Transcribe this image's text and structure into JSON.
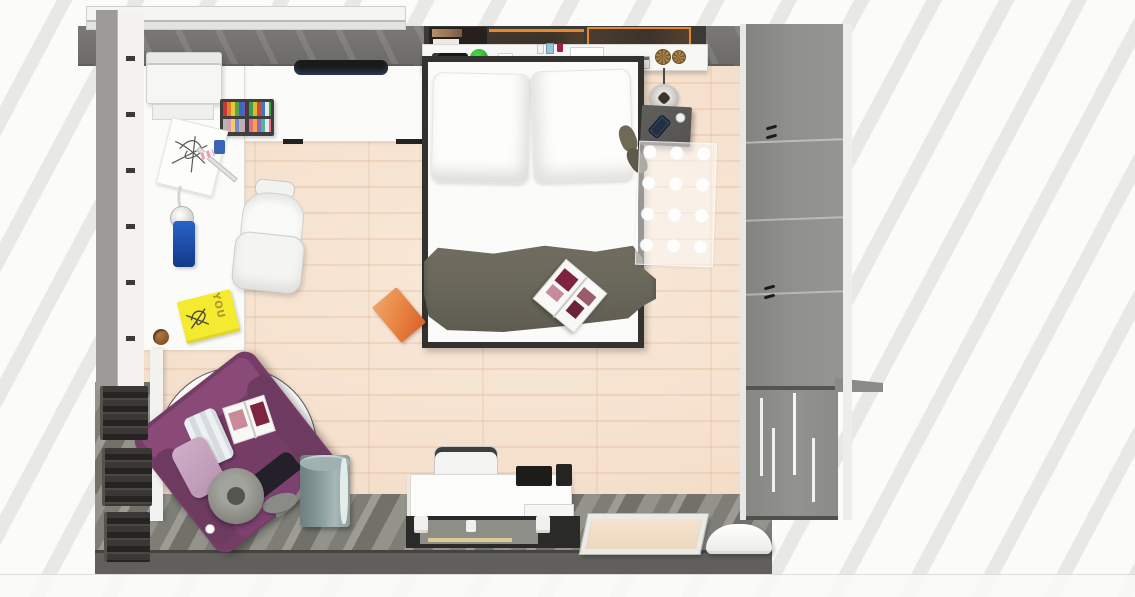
{
  "scene": {
    "description": "Top-down 3D rendering of a furnished bedroom with bed, corner desk, wardrobe and purple armchair"
  },
  "colors": {
    "wood_floor": "#f4dfcb",
    "wood_floor_light": "#f9e9d9",
    "wood_floor_dark": "#eed2b8",
    "gray_floor_a": "#93938c",
    "gray_floor_b": "#7e7e77",
    "gray_floor_c": "#9c9c95",
    "gray_floor_d": "#71716a",
    "desk_white": "#fbfbf9",
    "wall_gray": "#72716f",
    "wall_bottom": "#605f5b",
    "wardrobe_gray": "#8b8b89",
    "bed_frame": "#34322e",
    "blanket_gray": "#6b685c",
    "chair_purple": "#753d66",
    "chair_purple_light": "#8a4a78",
    "poster_orange": "#e8862a",
    "plant_green": "#2db92d",
    "bottle_blue": "#2a62c8",
    "book_yellow": "#f4ea2f",
    "book_orange": "#e8813f",
    "bin_teal": "#8da0a0",
    "basket_brown": "#9a7a4a",
    "magazine_maroon": "#7e2440",
    "magazine_pink": "#c98a9a"
  },
  "objects": {
    "window": {
      "label": "Window with white frame"
    },
    "posters": {
      "label": "Wall posters with orange frames"
    },
    "printer": {
      "label": "White printer"
    },
    "wall_monitor": {
      "label": "Black wall-mounted monitor"
    },
    "art_set": {
      "label": "Open art supplies case"
    },
    "sketch": {
      "label": "Sketch paper with drawing"
    },
    "ruler": {
      "label": "Ruler"
    },
    "desk_lamp": {
      "label": "Desk lamp"
    },
    "blue_bottle": {
      "label": "Blue bottle"
    },
    "you_book": {
      "label": "Yellow book",
      "text": "YOU"
    },
    "cookie": {
      "label": "Cookie"
    },
    "office_chair": {
      "label": "White office chair"
    },
    "corner_desk": {
      "label": "White corner desk"
    },
    "bed": {
      "label": "Double bed with white linen"
    },
    "pillow_left": {
      "label": "Pillow"
    },
    "pillow_right": {
      "label": "Pillow"
    },
    "blanket": {
      "label": "Dark grey blanket"
    },
    "bed_magazine": {
      "label": "Open magazine on bed"
    },
    "orange_book": {
      "label": "Orange book on floor"
    },
    "headboard_shelf": {
      "label": "Headboard shelf"
    },
    "remote": {
      "label": "Black remote"
    },
    "plant": {
      "label": "Small green plant"
    },
    "keyboard": {
      "label": "Keyboard on shelf"
    },
    "baskets": {
      "label": "Woven baskets"
    },
    "pendant_lamp": {
      "label": "Pendant lamp"
    },
    "nightstand": {
      "label": "Grey nightstand"
    },
    "phone": {
      "label": "Smartphone"
    },
    "mug": {
      "label": "White mug"
    },
    "slippers": {
      "label": "Slippers"
    },
    "sheer_rug": {
      "label": "Sheer dotted runner rug"
    },
    "wardrobe": {
      "label": "Grey wardrobe"
    },
    "round_rug": {
      "label": "Round white rug"
    },
    "armchair": {
      "label": "Purple armchair"
    },
    "cushion_striped": {
      "label": "Striped cushion"
    },
    "cushion_pink": {
      "label": "Pink cushion"
    },
    "armchair_book": {
      "label": "Open book on armchair"
    },
    "floor_lamp": {
      "label": "Arc floor lamp"
    },
    "bin": {
      "label": "Waste bin"
    },
    "wall_books": {
      "label": "Books on wall shelves"
    },
    "desk": {
      "label": "White desk"
    },
    "desk_chair": {
      "label": "White desk chair"
    },
    "drawers": {
      "label": "Drawer unit"
    },
    "desk_mat": {
      "label": "Dark floor mat"
    },
    "corkboard": {
      "label": "Framed board leaning on wall"
    },
    "pet_bed": {
      "label": "White pet bed"
    }
  }
}
